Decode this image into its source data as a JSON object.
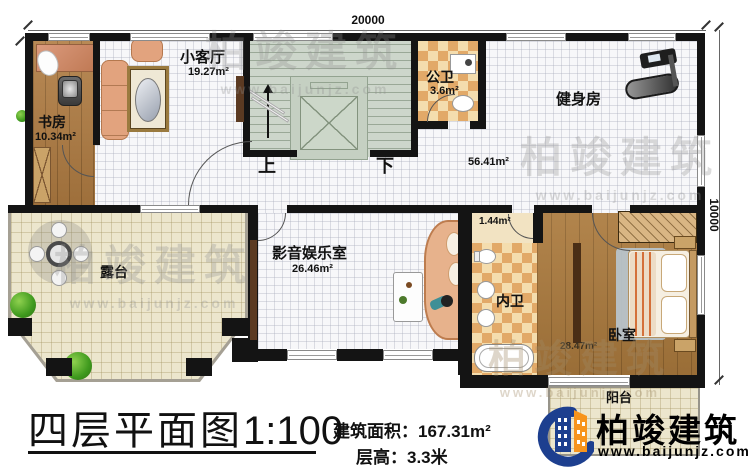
{
  "plan": {
    "dimensions": {
      "top": "20000",
      "right": "10000"
    },
    "stairs": {
      "up": "上",
      "down": "下"
    },
    "rooms": {
      "study": {
        "name": "书房",
        "area": "10.34m²"
      },
      "living": {
        "name": "小客厅",
        "area": "19.27m²"
      },
      "public_bath": {
        "name": "公卫",
        "area": "3.6m²"
      },
      "gym": {
        "name": "健身房",
        "area": "56.41m²"
      },
      "terrace": {
        "name": "露台"
      },
      "media": {
        "name": "影音娱乐室",
        "area": "26.46m²"
      },
      "inner_bath": {
        "name": "内卫",
        "area": "1.44m²"
      },
      "bedroom": {
        "name": "卧室",
        "area": "28.47m²"
      },
      "balcony": {
        "name": "阳台"
      }
    }
  },
  "footer": {
    "plan_title": "四层平面图",
    "plan_scale": "1:100",
    "area_label": "建筑面积：",
    "area_value": "167.31m²",
    "height_label": "层高：",
    "height_value": "3.3米"
  },
  "brand": {
    "name": "柏竣建筑",
    "website": "www.baijunjz.com",
    "blue": "#1d3f8f",
    "orange": "#f7941d"
  },
  "watermark": {
    "name": "柏竣建筑",
    "website": "www.baijunjz.com"
  },
  "colors": {
    "wall": "#141414",
    "wood": "#b07c42",
    "tile": "#f7f7f9",
    "terrace": "#ece6cd",
    "checker_tan": "#e2a968",
    "checker_cream": "#f4ddae",
    "stair": "#cdd6cb"
  }
}
